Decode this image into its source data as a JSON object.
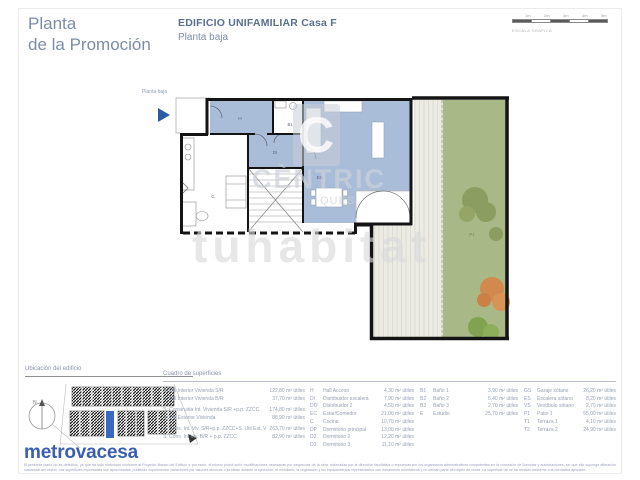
{
  "page": {
    "title_line1": "Planta",
    "title_line2": "de la Promoción",
    "header_title": "EDIFICIO UNIFAMILIAR Casa F",
    "header_subtitle": "Planta baja"
  },
  "scale_bar": {
    "labels": [
      "1m",
      "2m",
      "3m",
      "4m",
      "5m"
    ],
    "caption": "ESCALA GRÁFICA"
  },
  "plan": {
    "floor_label": "Planta baja",
    "unit_letter": "F",
    "labels": {
      "hall": "H",
      "bath1": "B1",
      "distributor": "DI",
      "living": "EC",
      "kitchen": "C",
      "patio": "P1"
    },
    "watermarks": {
      "logo_letter": "C",
      "line1": "CÈNTRIC",
      "line2": "QUES",
      "line3": "tuhabitat"
    },
    "colors": {
      "room_blue": "#a9bdd9",
      "garden_green": "#a9b887",
      "wall_black": "#141414",
      "marker_blue": "#2d5c9e"
    }
  },
  "location": {
    "label": "Ubicación del edificio",
    "north_label": "N"
  },
  "brand": {
    "name": "metrovacesa",
    "color": "#3a5fae"
  },
  "disclaimer": {
    "line1": "El presente plano no es definitivo, ya que ha sido elaborado conforme al Proyecto Básico del Edificio y, por tanto, el mismo podrá sufrir modificaciones necesarias por exigencias de la obra, ordenadas por la dirección facultativa o impuestas por los organismos administrativos competentes en la concesión de licencias y autorizaciones, sin que ello suponga alteración sustancial del objeto.",
    "line2": "Las superficies expresadas son aproximadas, pudiendo experimentar variaciones por razones técnicas o jurídicas durante la ejecución; el mobiliario, la vegetación y los equipamientos representados son meramente orientativos y no forman parte del objeto de venta. La superficie útil se ha medido conforme a la normativa aplicable."
  },
  "table": {
    "title": "Cuadro de superficies",
    "main_rows": [
      {
        "label": "S. Útil Interior Vivienda S/R",
        "value": "122,80 m² útiles"
      },
      {
        "label": "S. Útil Interior Vivienda B/R",
        "value": "37,70 m² útiles"
      },
      {
        "label": "S. Construida Int. Vivienda S/R +p.p. ZZCC",
        "value": "174,80 m² útiles"
      },
      {
        "label": "S. Útil Exterior Vivienda",
        "value": "88,90 m² útiles"
      },
      {
        "label": "S. Cons. Int. Viv. S/R+p.p. ZZCC+S. Útil Ext. Viv.",
        "value": "263,70 m² útiles"
      },
      {
        "label": "S. Cons. Int Viv. B/R + p.p. ZZCC",
        "value": "82,90 m² útiles"
      }
    ],
    "col2": [
      {
        "code": "H",
        "label": "Hall Acceso",
        "value": "4,30 m² útiles"
      },
      {
        "code": "DI",
        "label": "Distribuidor escalera",
        "value": "7,90 m² útiles"
      },
      {
        "code": "DI2",
        "label": "Distribuidor 2",
        "value": "4,50 m² útiles"
      },
      {
        "code": "EC",
        "label": "Estar/Comedor",
        "value": "21,00 m² útiles"
      },
      {
        "code": "C",
        "label": "Cocina",
        "value": "10,70 m² útiles"
      },
      {
        "code": "DP",
        "label": "Dormitorio principal",
        "value": "13,00 m² útiles"
      },
      {
        "code": "D2",
        "label": "Dormitorio 2",
        "value": "12,20 m² útiles"
      },
      {
        "code": "D3",
        "label": "Dormitorio 3",
        "value": "11,10 m² útiles"
      }
    ],
    "col3": [
      {
        "code": "B1",
        "label": "Baño 1",
        "value": "3,90 m² útiles"
      },
      {
        "code": "B2",
        "label": "Baño 2",
        "value": "5,40 m² útiles"
      },
      {
        "code": "B3",
        "label": "Baño 3",
        "value": "2,70 m² útiles"
      },
      {
        "code": "E",
        "label": "Estudio",
        "value": "25,70 m² útiles"
      }
    ],
    "col4": [
      {
        "code": "GS",
        "label": "Garaje sótano",
        "value": "26,20 m² útiles"
      },
      {
        "code": "ES",
        "label": "Escalera sótano",
        "value": "8,20 m² útiles"
      },
      {
        "code": "VS",
        "label": "Vestíbulo sótano",
        "value": "2,70 m² útiles"
      },
      {
        "code": "P1",
        "label": "Patio 1",
        "value": "55,00 m² útiles"
      },
      {
        "code": "T1",
        "label": "Terraza 1",
        "value": "4,10 m² útiles"
      },
      {
        "code": "T2",
        "label": "Terraza 2",
        "value": "24,90 m² útiles"
      }
    ]
  }
}
